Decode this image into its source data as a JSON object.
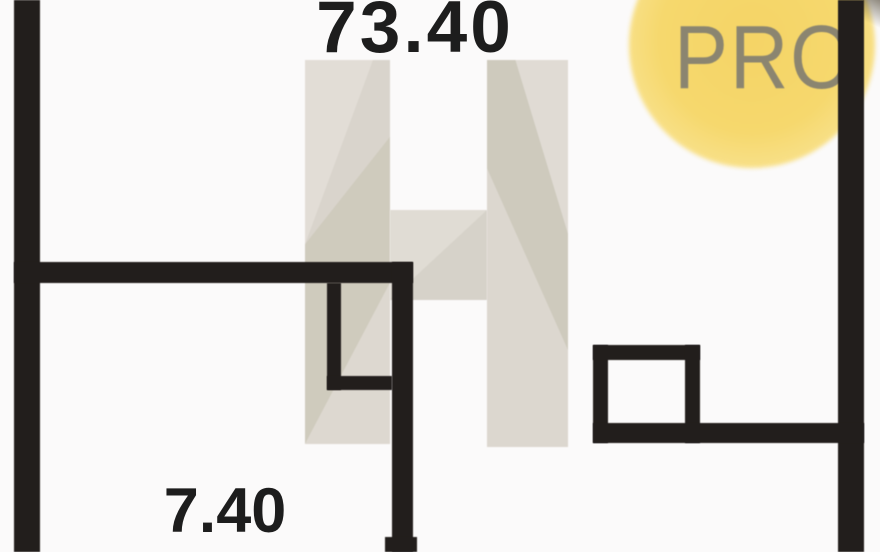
{
  "floorplan": {
    "kind": "floor-plan-photo",
    "labels": {
      "total_area": "73.40",
      "room_area": "7.40"
    },
    "badge": {
      "text": "PRO"
    },
    "watermark": {
      "shape": "letter-H-faceted"
    },
    "colors": {
      "wall": "#221e1c",
      "background": "#fbfafa",
      "label_text": "#1d1d1d",
      "badge_fill": "#f6d76c",
      "badge_text": "#8b8570",
      "watermark_beige": "#d8d3cb",
      "watermark_light": "#e2ddd6",
      "watermark_olive": "#cfcbbd"
    }
  }
}
